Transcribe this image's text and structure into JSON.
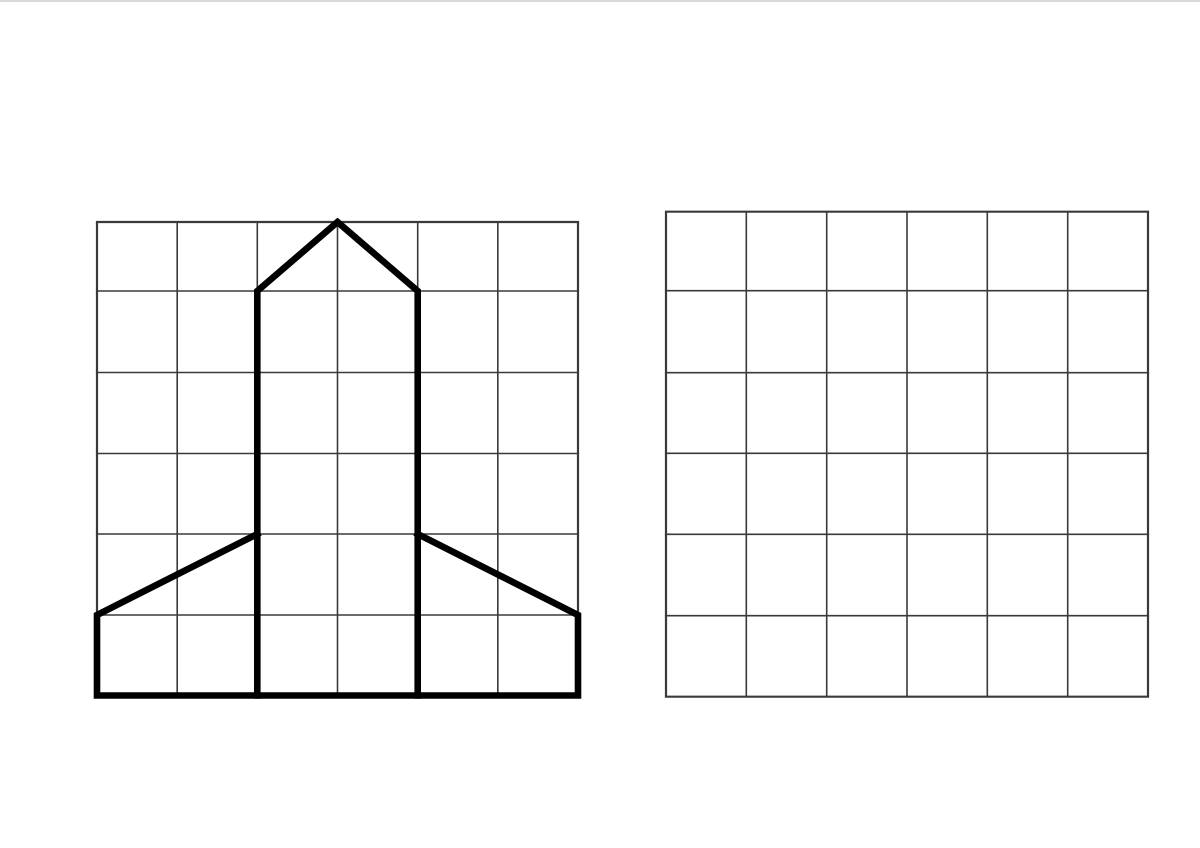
{
  "canvas": {
    "width": 1200,
    "height": 848
  },
  "colors": {
    "background": "#ffffff",
    "grid_line": "#3a3a3a",
    "shape_stroke": "#000000",
    "page_edge": "#d8d8d8"
  },
  "left_grid": {
    "role": "model grid with rocket drawing",
    "cols": 6,
    "rows": 6,
    "cols_x": [
      97,
      177.2,
      257.3,
      337.5,
      417.7,
      497.8,
      578
    ],
    "rows_y": [
      222,
      291,
      372.5,
      453.5,
      534,
      615,
      695.5
    ],
    "inner_line_width": 1.6,
    "border_line_width": 2.2
  },
  "right_grid": {
    "role": "blank practice copy grid",
    "cols": 6,
    "rows": 6,
    "cols_x": [
      666,
      746.3,
      826.7,
      907,
      987.3,
      1067.7,
      1148
    ],
    "rows_y": [
      211.7,
      290.7,
      372.7,
      453.3,
      534.3,
      615.7,
      696.7
    ],
    "inner_line_width": 1.6,
    "border_line_width": 2.2
  },
  "rocket": {
    "stroke_width": 6.6,
    "drawn_on": "left_grid",
    "polylines_grid_units": [
      [
        [
          2,
          6
        ],
        [
          2,
          1
        ],
        [
          3,
          0
        ],
        [
          4,
          1
        ],
        [
          4,
          6
        ]
      ],
      [
        [
          2,
          4
        ],
        [
          0,
          5
        ],
        [
          0,
          6
        ],
        [
          6,
          6
        ],
        [
          6,
          5
        ],
        [
          4,
          4
        ]
      ]
    ]
  }
}
